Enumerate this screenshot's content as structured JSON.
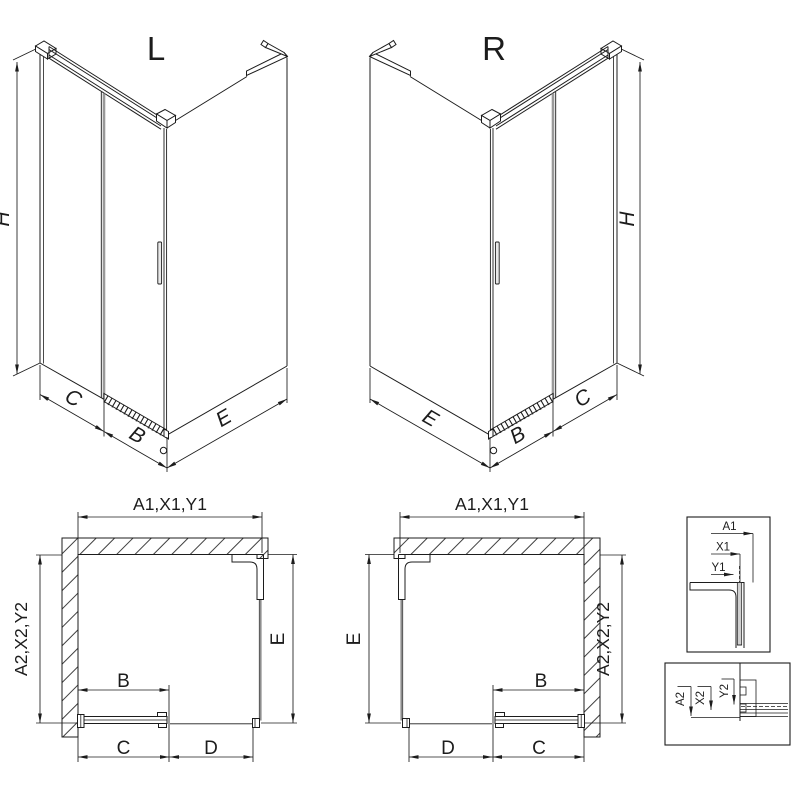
{
  "drawing": {
    "iso_left": {
      "title": "L",
      "height_label": "H",
      "side_label": "C",
      "door_label": "B",
      "front_label": "E"
    },
    "iso_right": {
      "title": "R",
      "height_label": "H",
      "side_label": "C",
      "door_label": "B",
      "front_label": "E"
    },
    "plan_left": {
      "top_label": "A1,X1,Y1",
      "left_label": "A2,X2,Y2",
      "right_label": "E",
      "door_label": "B",
      "bottom_left_label": "C",
      "bottom_right_label": "D"
    },
    "plan_right": {
      "top_label": "A1,X1,Y1",
      "left_label": "E",
      "right_label": "A2,X2,Y2",
      "door_label": "B",
      "bottom_left_label": "D",
      "bottom_right_label": "C"
    },
    "detail_glass_profile": {
      "labels": {
        "a": "A1",
        "x": "X1",
        "y": "Y1"
      }
    },
    "detail_bottom_rail": {
      "labels": {
        "a": "A2",
        "x": "X2",
        "y": "Y2"
      }
    }
  },
  "colors": {
    "line": "#1c1c1c",
    "glass_edge": "#9a9a9a",
    "background": "#ffffff"
  }
}
